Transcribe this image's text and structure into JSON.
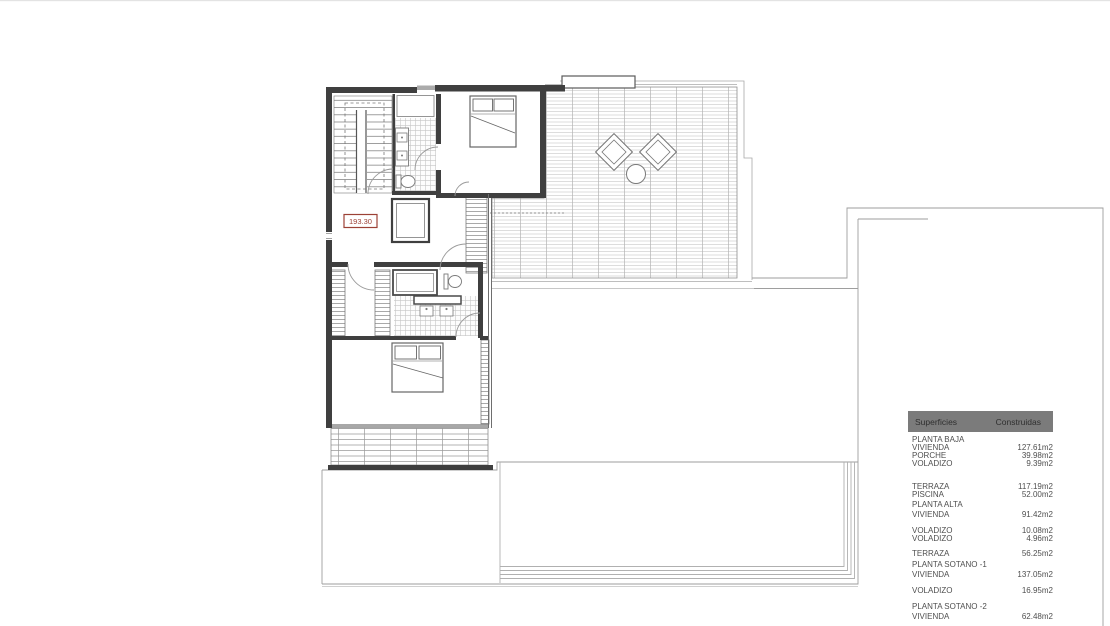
{
  "plan": {
    "area_label": "193.30"
  },
  "areas_table": {
    "header": {
      "superficies": "Superficies",
      "construidas": "Construidas"
    },
    "rows": [
      {
        "label": "PLANTA BAJA",
        "value": "",
        "gap": 0
      },
      {
        "label": "VIVIENDA",
        "value": "127.61m2",
        "gap": 0
      },
      {
        "label": "PORCHE",
        "value": "39.98m2",
        "gap": 0
      },
      {
        "label": "VOLADIZO",
        "value": "9.39m2",
        "gap": 0
      },
      {
        "label": "TERRAZA",
        "value": "117.19m2",
        "gap": 15
      },
      {
        "label": "PISCINA",
        "value": "52.00m2",
        "gap": 0
      },
      {
        "label": "PLANTA ALTA",
        "value": "",
        "gap": 2
      },
      {
        "label": "VIVIENDA",
        "value": "91.42m2",
        "gap": 2
      },
      {
        "label": "VOLADIZO",
        "value": "10.08m2",
        "gap": 8
      },
      {
        "label": "VOLADIZO",
        "value": "4.96m2",
        "gap": 0
      },
      {
        "label": "TERRAZA",
        "value": "56.25m2",
        "gap": 7
      },
      {
        "label": "PLANTA SOTANO -1",
        "value": "",
        "gap": 3
      },
      {
        "label": "VIVIENDA",
        "value": "137.05m2",
        "gap": 2
      },
      {
        "label": "VOLADIZO",
        "value": "16.95m2",
        "gap": 8
      },
      {
        "label": "PLANTA SOTANO -2",
        "value": "",
        "gap": 8
      },
      {
        "label": "VIVIENDA",
        "value": "62.48m2",
        "gap": 2
      }
    ]
  },
  "colors": {
    "label_red": "#9c4136",
    "table_header_bg": "#7b7b7b",
    "table_header_text": "#2f2f2f",
    "table_text": "#4f4f4f",
    "wall_dark": "#3f3f3f",
    "line_light": "#b0b0b0"
  }
}
